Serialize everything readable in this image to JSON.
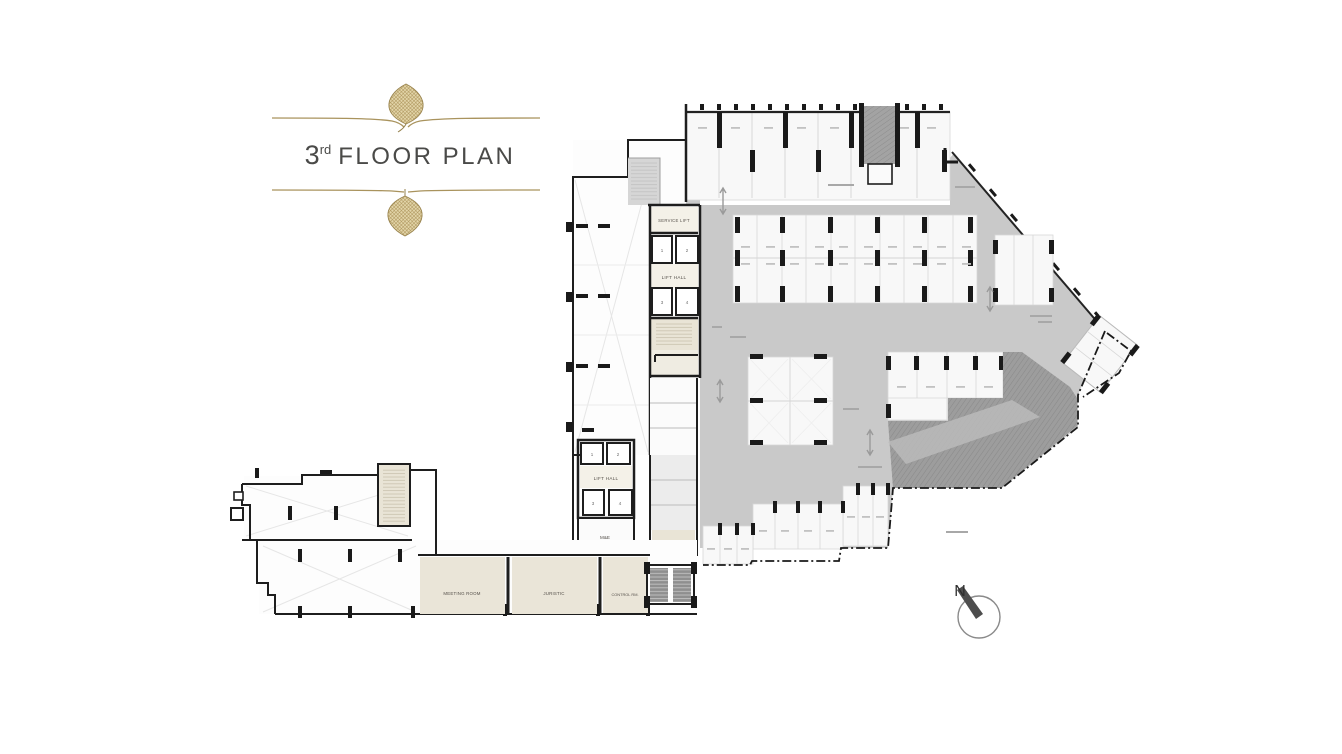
{
  "title": {
    "number": "3",
    "ordinal": "rd",
    "text": "FLOOR PLAN"
  },
  "compass": {
    "north_label": "N"
  },
  "plan": {
    "labels": {
      "service_lift": "SERVICE LIFT",
      "lift_hall_upper": "LIFT HALL",
      "lift_hall_lower": "LIFT HALL",
      "m_and_e": "M&E",
      "meeting_room": "MEETING ROOM",
      "juristic": "JURISTIC",
      "control_room": "CONTROL RM."
    },
    "lift_numbers": {
      "upper": [
        "1",
        "2",
        "3",
        "4"
      ],
      "lower": [
        "1",
        "2",
        "3",
        "4"
      ]
    }
  },
  "colors": {
    "gold": "#a9935d",
    "wall": "#1e1e1e",
    "aisle_gray": "#c9c9c9",
    "ramp_gray": "#9d9d9d",
    "room_beige": "#eae5d8"
  }
}
